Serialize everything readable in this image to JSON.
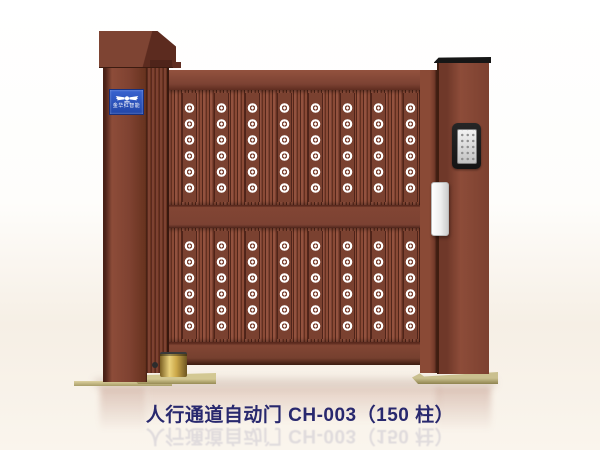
{
  "product": {
    "caption": "人行通道自动门 CH-003（150 柱）"
  },
  "left_post": {
    "brand_sign": {
      "icon": "wings-emblem",
      "text": "金华红智能",
      "bg_color": "#2b50b8"
    }
  },
  "right_post": {
    "device": "access-keypad"
  },
  "colors": {
    "gate_primary": "#7c4233",
    "gate_highlight": "#8d4c39",
    "gate_shadow": "#5a291d",
    "rosette": "#ffffff",
    "caption_text": "#28286e",
    "base_plate_gold": "#cac08f",
    "caster_brass": "#ead27c",
    "sign_blue": "#2b50b8",
    "background_bottom": "#f6efe5"
  }
}
